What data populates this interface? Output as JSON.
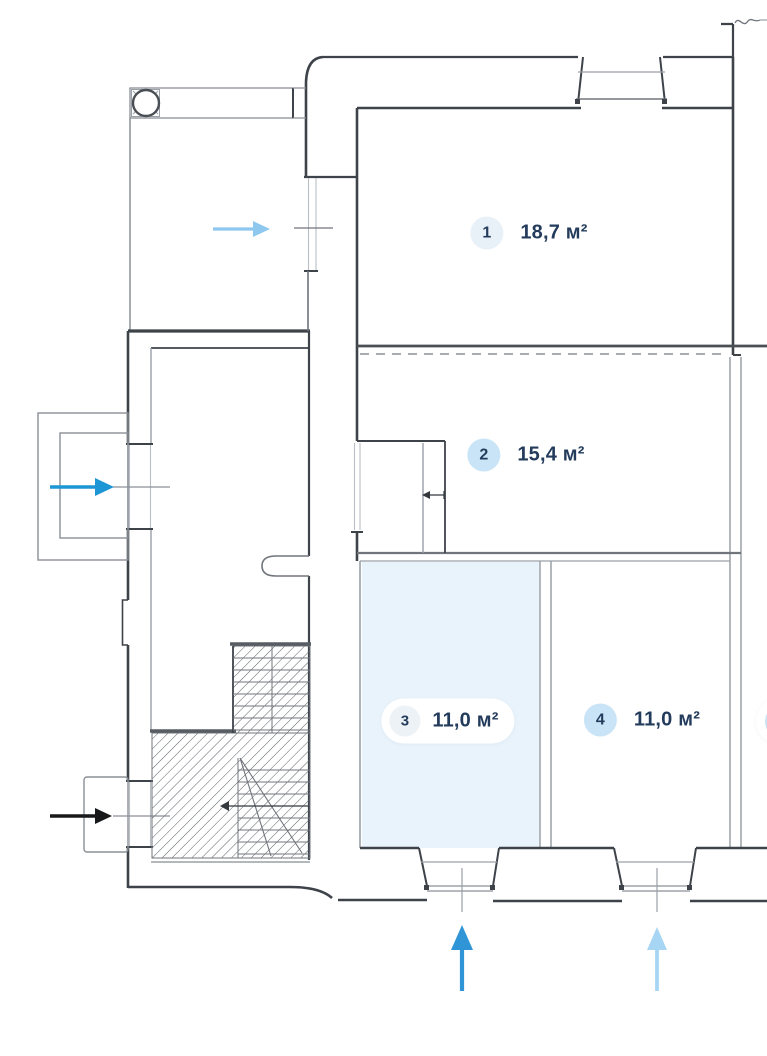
{
  "floor_plan": {
    "rooms": [
      {
        "number": "1",
        "area": "18,7 м²",
        "highlighted": false
      },
      {
        "number": "2",
        "area": "15,4 м²",
        "highlighted": false
      },
      {
        "number": "3",
        "area": "11,0 м²",
        "highlighted": true
      },
      {
        "number": "4",
        "area": "11,0 м²",
        "highlighted": false
      }
    ],
    "arrows": [
      {
        "name": "entrance-arrow-top-left",
        "direction": "right",
        "color": "#8ec8ef"
      },
      {
        "name": "entrance-arrow-left",
        "direction": "right",
        "color": "#1d96d6"
      },
      {
        "name": "entrance-arrow-bottom-left",
        "direction": "right",
        "color": "#17191b"
      },
      {
        "name": "entrance-arrow-room3",
        "direction": "up",
        "color": "#2f95d6"
      },
      {
        "name": "entrance-arrow-room4",
        "direction": "up",
        "color": "#a6d6f4"
      }
    ],
    "colors": {
      "highlight_room_fill": "#e9f3fb",
      "badge_blue": "#c8e4f6",
      "badge_light": "#e8f0f8",
      "label_text": "#243c5c",
      "wall_dark": "#3e434a",
      "wall_gray": "#9aa0a7"
    }
  }
}
